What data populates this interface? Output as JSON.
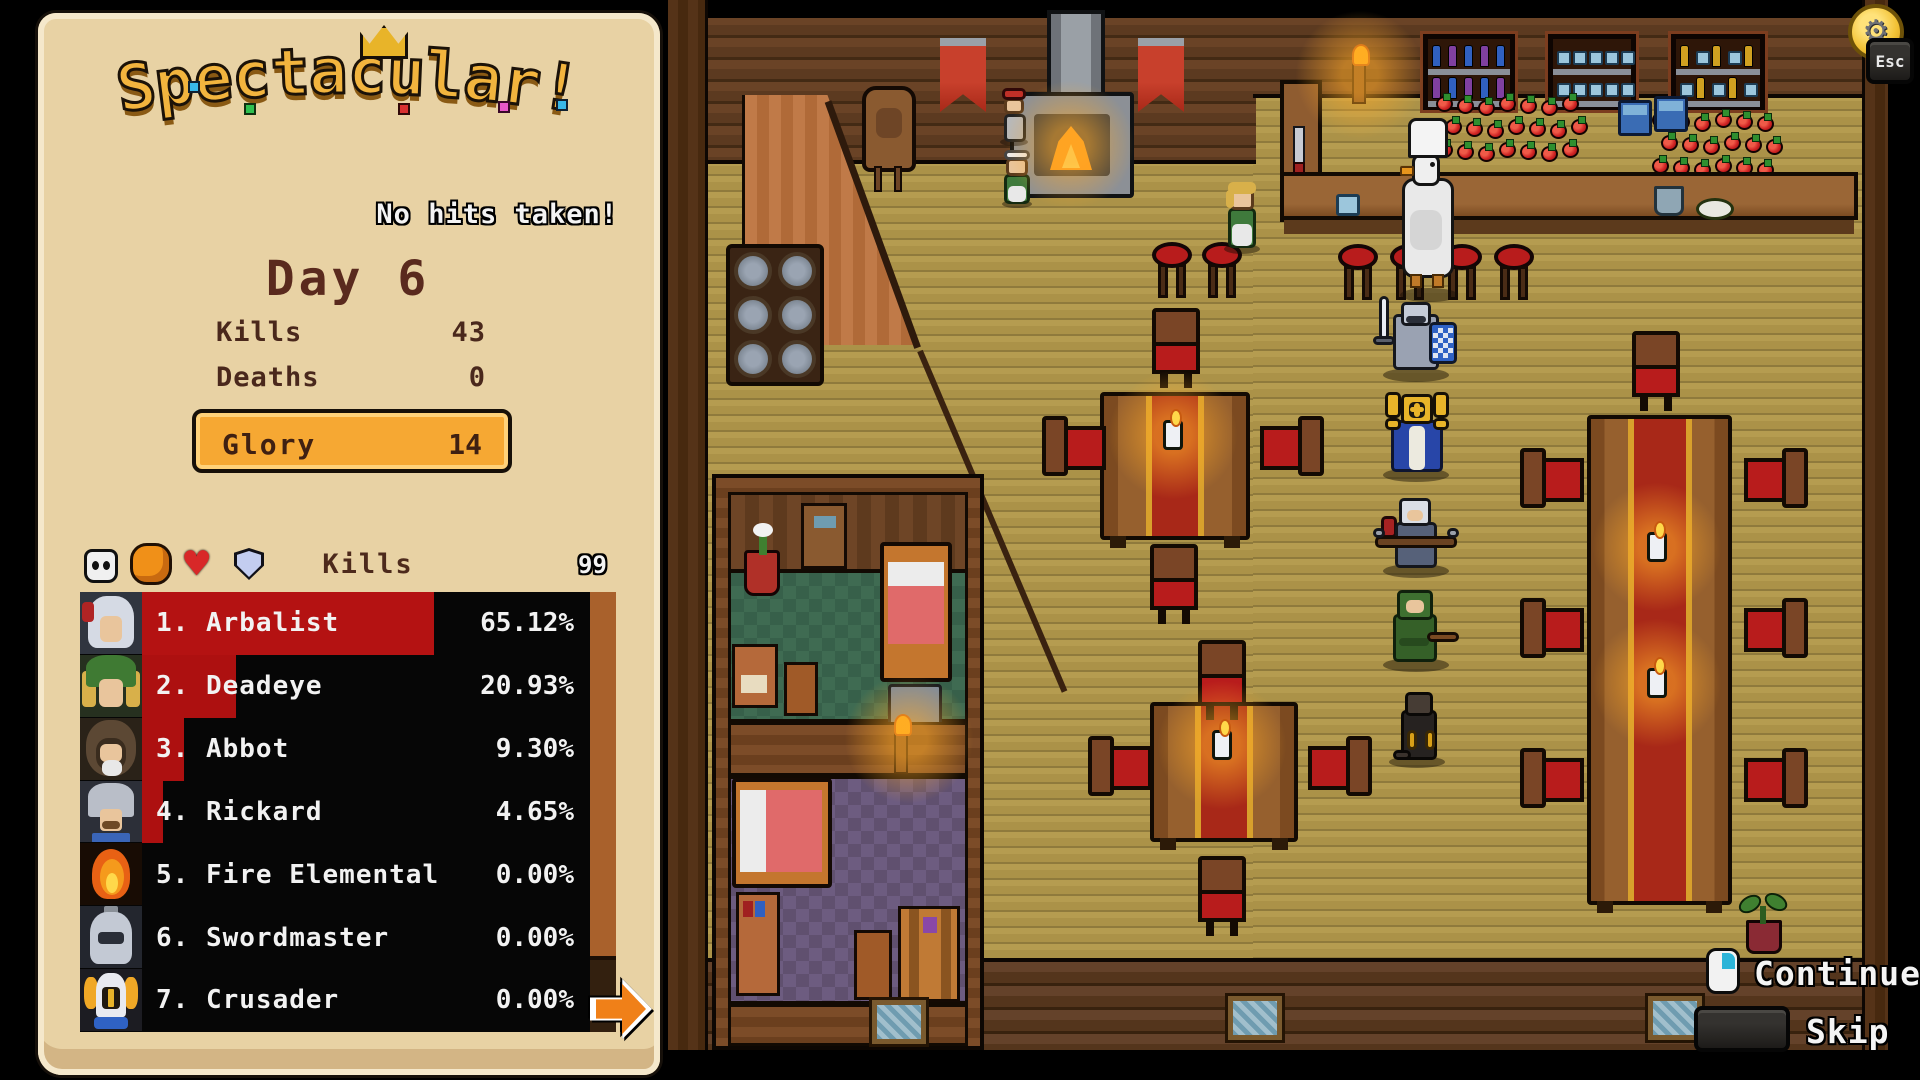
{
  "panel": {
    "title": "Spectacular!",
    "subtitle": "No hits taken!",
    "day_label": "Day 6",
    "stats": [
      {
        "label": "Kills",
        "value": "43"
      },
      {
        "label": "Deaths",
        "value": "0"
      }
    ],
    "glory": {
      "label": "Glory",
      "value": "14"
    },
    "tabs": [
      {
        "icon": "skull-icon",
        "selected": false
      },
      {
        "icon": "fist-icon",
        "selected": true
      },
      {
        "icon": "heart-icon",
        "selected": false
      },
      {
        "icon": "shield-icon",
        "selected": false
      }
    ],
    "leaderboard": {
      "metric_label": "Kills",
      "scale_max": "99",
      "rows": [
        {
          "rank": 1,
          "name": "Arbalist",
          "percent": "65.12%",
          "pct": 65.12,
          "avatar": "arbalist"
        },
        {
          "rank": 2,
          "name": "Deadeye",
          "percent": "20.93%",
          "pct": 20.93,
          "avatar": "deadeye"
        },
        {
          "rank": 3,
          "name": "Abbot",
          "percent": "9.30%",
          "pct": 9.3,
          "avatar": "abbot"
        },
        {
          "rank": 4,
          "name": "Rickard",
          "percent": "4.65%",
          "pct": 4.65,
          "avatar": "rickard"
        },
        {
          "rank": 5,
          "name": "Fire Elemental",
          "percent": "0.00%",
          "pct": 0,
          "avatar": "fire-elemental"
        },
        {
          "rank": 6,
          "name": "Swordmaster",
          "percent": "0.00%",
          "pct": 0,
          "avatar": "swordmaster"
        },
        {
          "rank": 7,
          "name": "Crusader",
          "percent": "0.00%",
          "pct": 0,
          "avatar": "crusader"
        }
      ]
    },
    "next_page_icon": "arrow-right-icon"
  },
  "hud": {
    "esc": {
      "key_label": "Esc",
      "icon": "gear-coin-icon"
    },
    "continue": {
      "label": "Continue",
      "icon": "mouse-icon"
    },
    "skip": {
      "label": "Skip",
      "icon": "spacebar-icon"
    }
  },
  "palette": {
    "parchment": "#e8d2a4",
    "glory_orange": "#f6a833",
    "leaderboard_red": "#ad1010",
    "leaderboard_black": "#060606",
    "floor_tan": "#ab9248",
    "wall_brown": "#5c3a20",
    "chair_red": "#b81c1c",
    "candle_glow": "#ffaa28",
    "arrow_orange": "#f08018"
  }
}
